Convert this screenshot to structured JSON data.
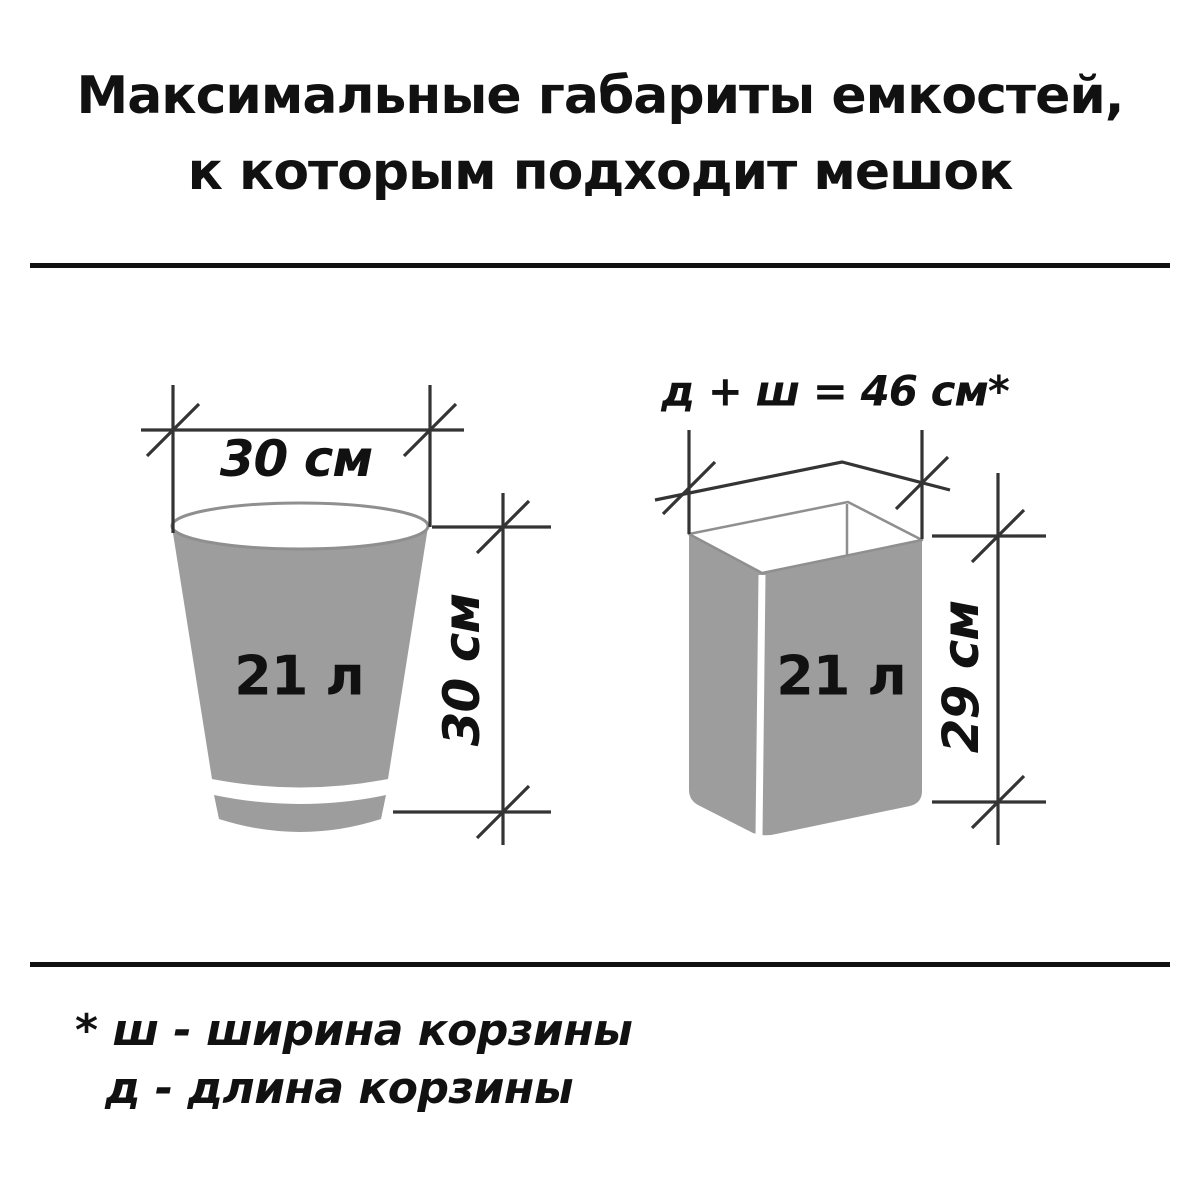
{
  "diagram_type": "product-dimension-infographic",
  "title": {
    "line1": "Максимальные габариты емкостей,",
    "line2": "к которым подходит мешок"
  },
  "bucket": {
    "shape": "round tapered bin",
    "volume_label": "21 л",
    "width_label": "30 см",
    "height_label": "30 см"
  },
  "basket": {
    "shape": "rectangular basket (perspective view)",
    "volume_label": "21 л",
    "formula_label": "д + ш = 46 см*",
    "height_label": "29 см"
  },
  "footnote": {
    "line1": "* ш - ширина корзины",
    "line2": "д  - длина корзины"
  },
  "colors": {
    "container_fill": "#9d9d9d",
    "outline": "#8f8f8f",
    "dimension_lines": "#343434",
    "text": "#111111"
  }
}
